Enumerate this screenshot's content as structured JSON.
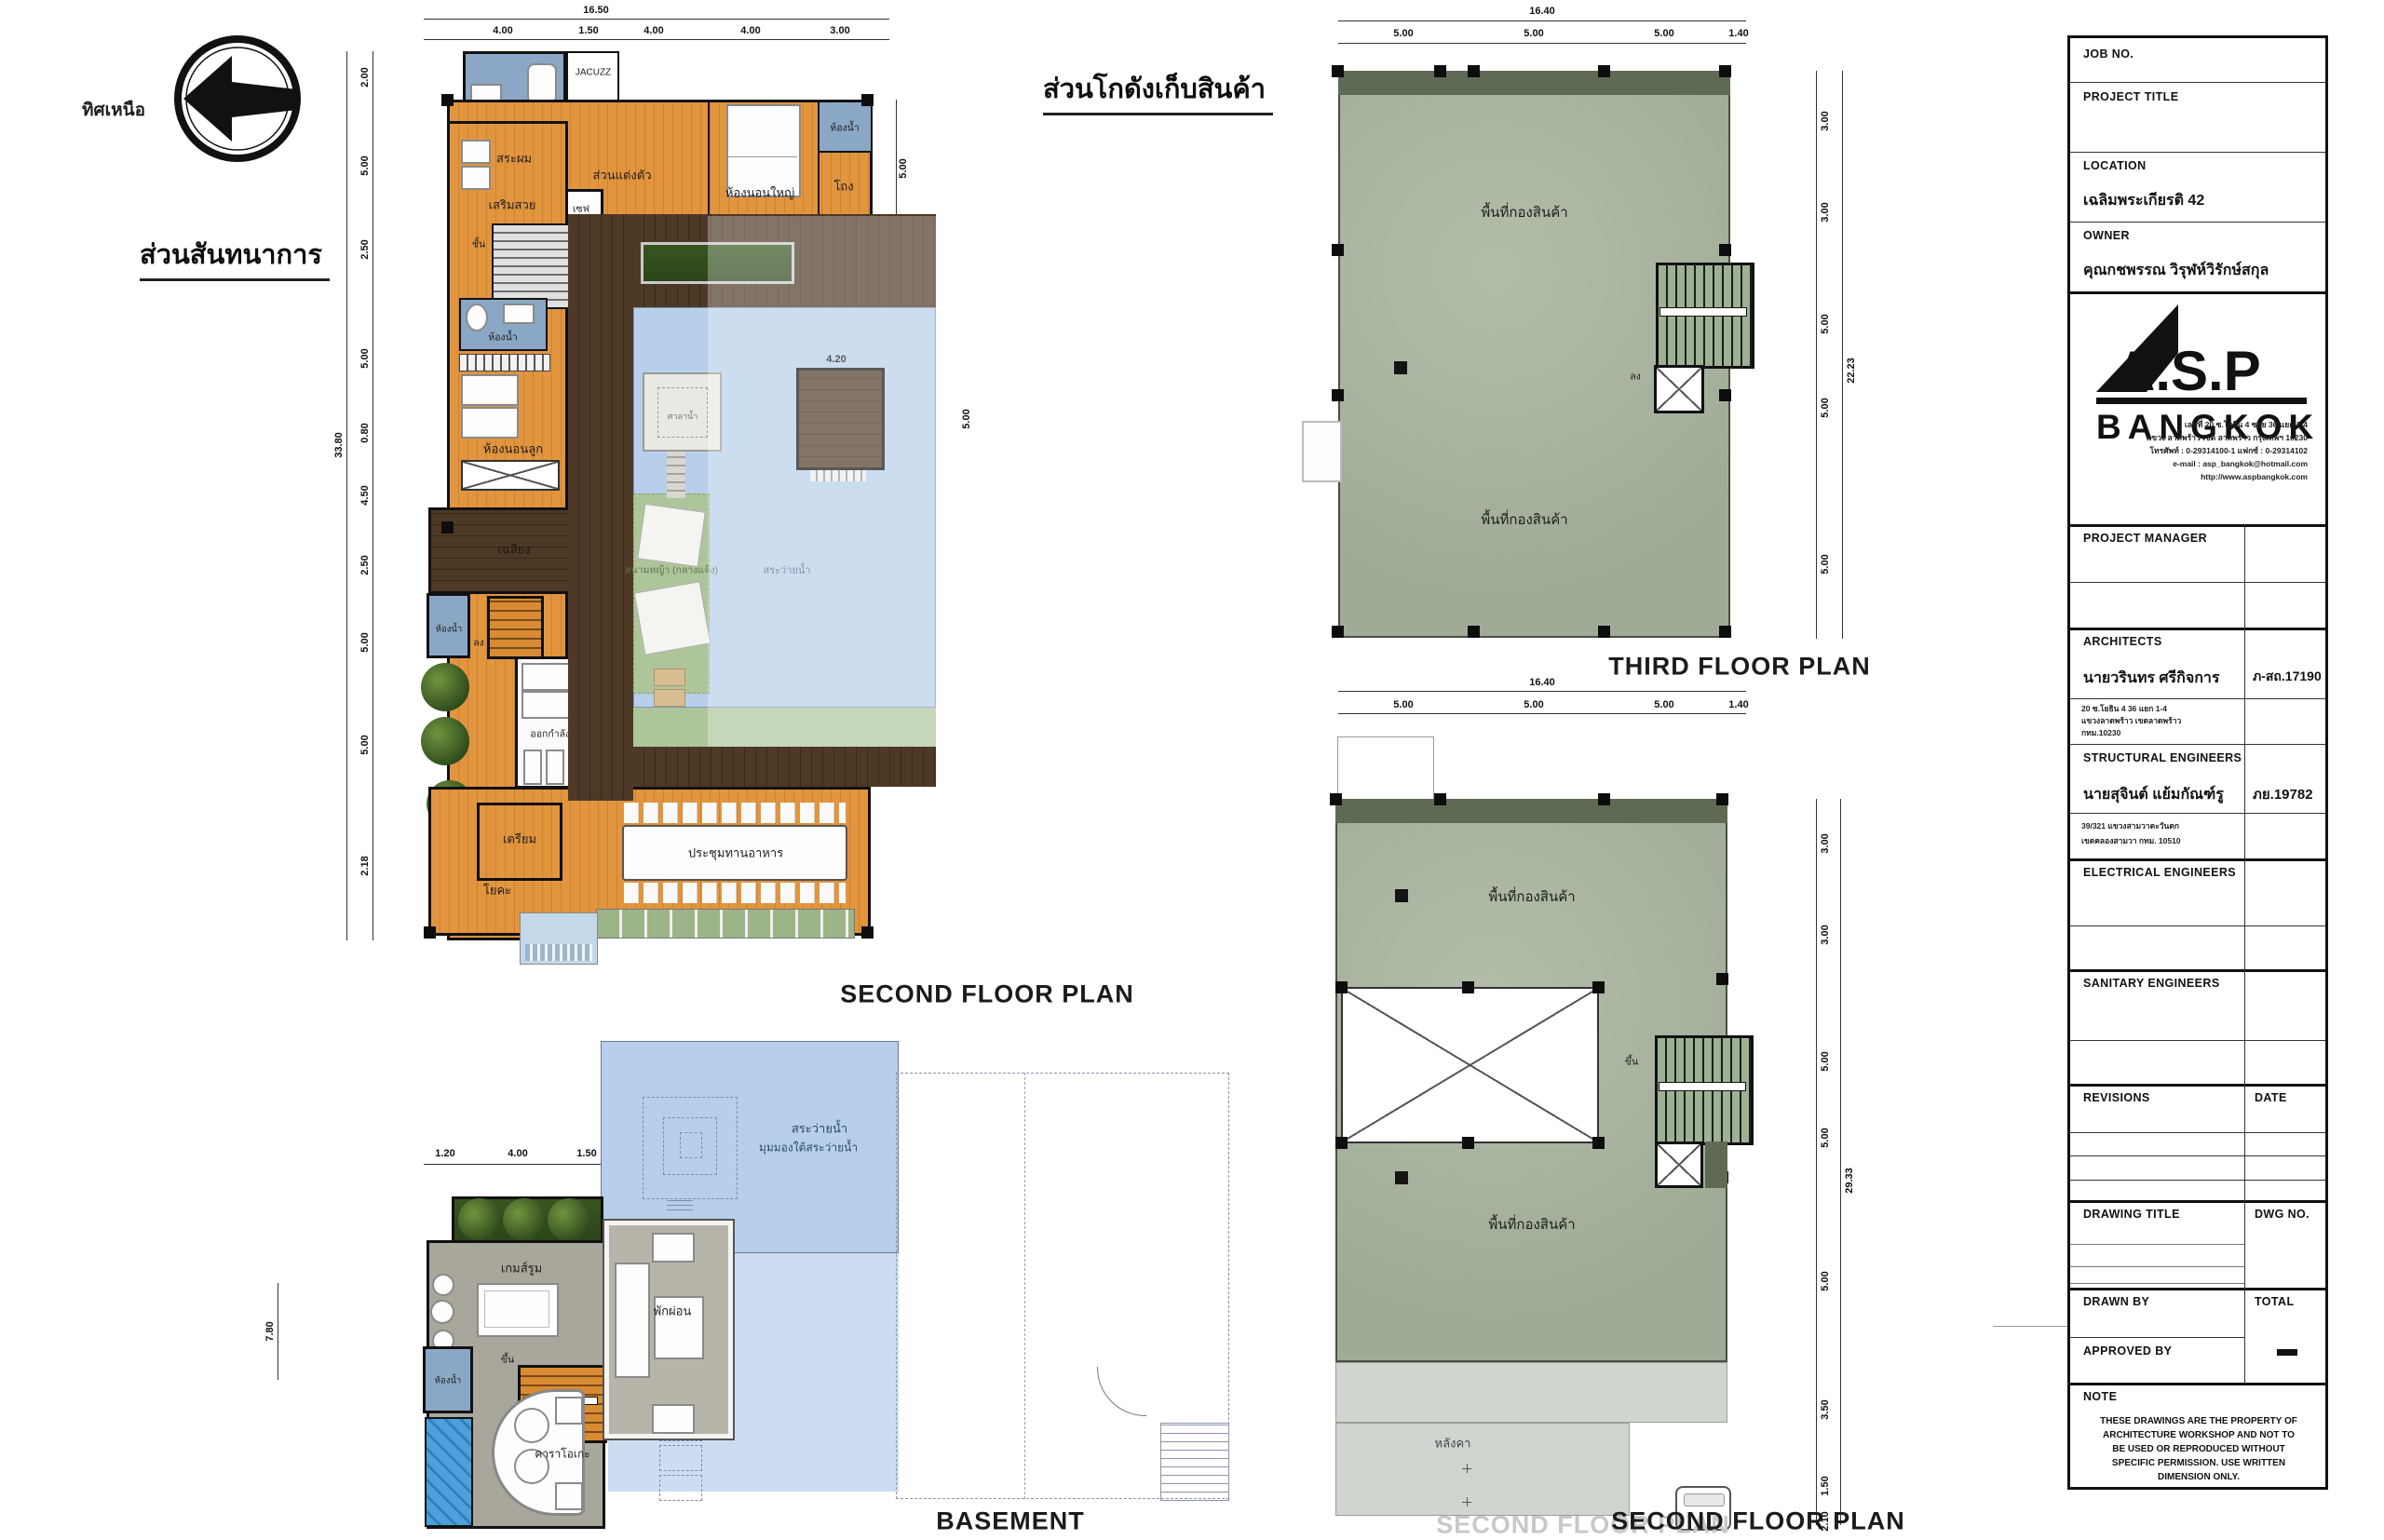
{
  "north": {
    "label": "ทิศเหนือ"
  },
  "recreation": {
    "heading": "ส่วนสันทนาการ",
    "caption": "SECOND FLOOR PLAN",
    "dims": {
      "top_total": "16.50",
      "top": [
        "4.00",
        "1.50",
        "4.00",
        "4.00",
        "3.00"
      ],
      "left_total": "33.80",
      "left": [
        "2.00",
        "5.00",
        "2.50",
        "5.00",
        "0.80",
        "4.50",
        "2.50",
        "5.00",
        "5.00",
        "2.18"
      ],
      "right": [
        "5.00",
        "2.50"
      ],
      "pav_w": "4.20",
      "pav_h": "5.00"
    },
    "rooms": {
      "bath": "ห้องน้ำ",
      "jacuzzi": "JACUZZ",
      "hair_wash": "สระผม",
      "beauty": "เสริมสวย",
      "stair": "ชั้น",
      "dressing": "ส่วนแต่งตัว",
      "safe": "เซฟ",
      "master_bedroom": "ห้องนอนใหญ่",
      "hall": "โถง",
      "kids_bedroom": "ห้องนอนลูก",
      "terrace": "เฉลียง",
      "down": "ลง",
      "exercise": "ออกกำลังกาย",
      "prep": "เตรียม",
      "yoga": "โยคะ",
      "dining": "ประชุมทานอาหาร",
      "lawn": "สนามหญ้า (กลางแจ้ง)",
      "pool": "สระว่ายน้ำ",
      "pavilion": "ศาลาน้ำ"
    }
  },
  "warehouse": {
    "heading": "ส่วนโกดังเก็บสินค้า",
    "third": {
      "caption": "THIRD FLOOR PLAN",
      "storage": "พื้นที่กองสินค้า",
      "down": "ลง",
      "dims": {
        "top_total": "16.40",
        "top": [
          "5.00",
          "5.00",
          "5.00",
          "1.40"
        ],
        "right": [
          "3.00",
          "3.00",
          "5.00",
          "5.00",
          "5.00"
        ],
        "right_total": "22.23"
      }
    },
    "second": {
      "caption": "SECOND FLOOR PLAN",
      "storage": "พื้นที่กองสินค้า",
      "up": "ขึ้น",
      "roof": "หลังคา",
      "dims": {
        "top_total": "16.40",
        "top": [
          "5.00",
          "5.00",
          "5.00",
          "1.40"
        ],
        "right": [
          "3.00",
          "3.00",
          "5.00",
          "5.00",
          "5.00",
          "3.50",
          "1.50",
          "2.10"
        ],
        "right_total": "29.33"
      }
    }
  },
  "basement": {
    "caption": "BASEMENT",
    "pool_line1": "สระว่ายน้ำ",
    "pool_line2": "มุมมองใต้สระว่ายน้ำ",
    "game_room": "เกมส์รูม",
    "relax": "พักผ่อน",
    "up": "ขึ้น",
    "bath": "ห้องน้ำ",
    "karaoke": "คาราโอเกะ",
    "dims": {
      "top": [
        "1.20",
        "4.00",
        "1.50"
      ],
      "left_total": "7.80"
    }
  },
  "title_block": {
    "job_no": "JOB NO.",
    "project_title": "PROJECT TITLE",
    "location": "LOCATION",
    "location_value": "เฉลิมพระเกียรติ 42",
    "owner": "OWNER",
    "owner_value": "คุณกชพรรณ วิรุฬห์วิรักษ์สกุล",
    "logo": {
      "name": "A.S.P",
      "city": "BANGKOK",
      "address": [
        "เลขที่ 20 ซ.โยธิน 4 ซอย 36 แยก 1-4",
        "แขวง ลาดพร้าว เขต ลาดพร้าว กรุงเทพฯ 10230",
        "โทรศัพท์ : 0-29314100-1 แฟกซ์ : 0-29314102",
        "e-mail : asp_bangkok@hotmail.com",
        "http://www.aspbangkok.com"
      ]
    },
    "project_manager": "PROJECT MANAGER",
    "architects": "ARCHITECTS",
    "architect_name": "นายวรินทร ศรีกิจการ",
    "architect_reg": "ภ-สถ.17190",
    "architect_address": [
      "20 ซ.โยธิน 4 36 แยก 1-4",
      "แขวงลาดพร้าว เขตลาดพร้าว",
      "กทม.10230"
    ],
    "structural": "STRUCTURAL ENGINEERS",
    "structural_name": "นายสุจินต์ แย้มกัณฑ์รู",
    "structural_reg": "ภย.19782",
    "structural_address": [
      "39/321 แขวงสามวาตะวันตก",
      "เขตคลองสามวา กทม. 10510"
    ],
    "electrical": "ELECTRICAL ENGINEERS",
    "sanitary": "SANITARY ENGINEERS",
    "revisions": "REVISIONS",
    "date": "DATE",
    "drawing_title": "DRAWING TITLE",
    "dwg_no": "DWG NO.",
    "drawn_by": "DRAWN BY",
    "total": "TOTAL",
    "approved_by": "APPROVED BY",
    "note": "NOTE",
    "note_text": "THESE DRAWINGS ARE THE PROPERTY OF ARCHITECTURE WORKSHOP AND NOT TO BE USED OR REPRODUCED WITHOUT SPECIFIC PERMISSION. USE WRITTEN DIMENSION ONLY."
  }
}
